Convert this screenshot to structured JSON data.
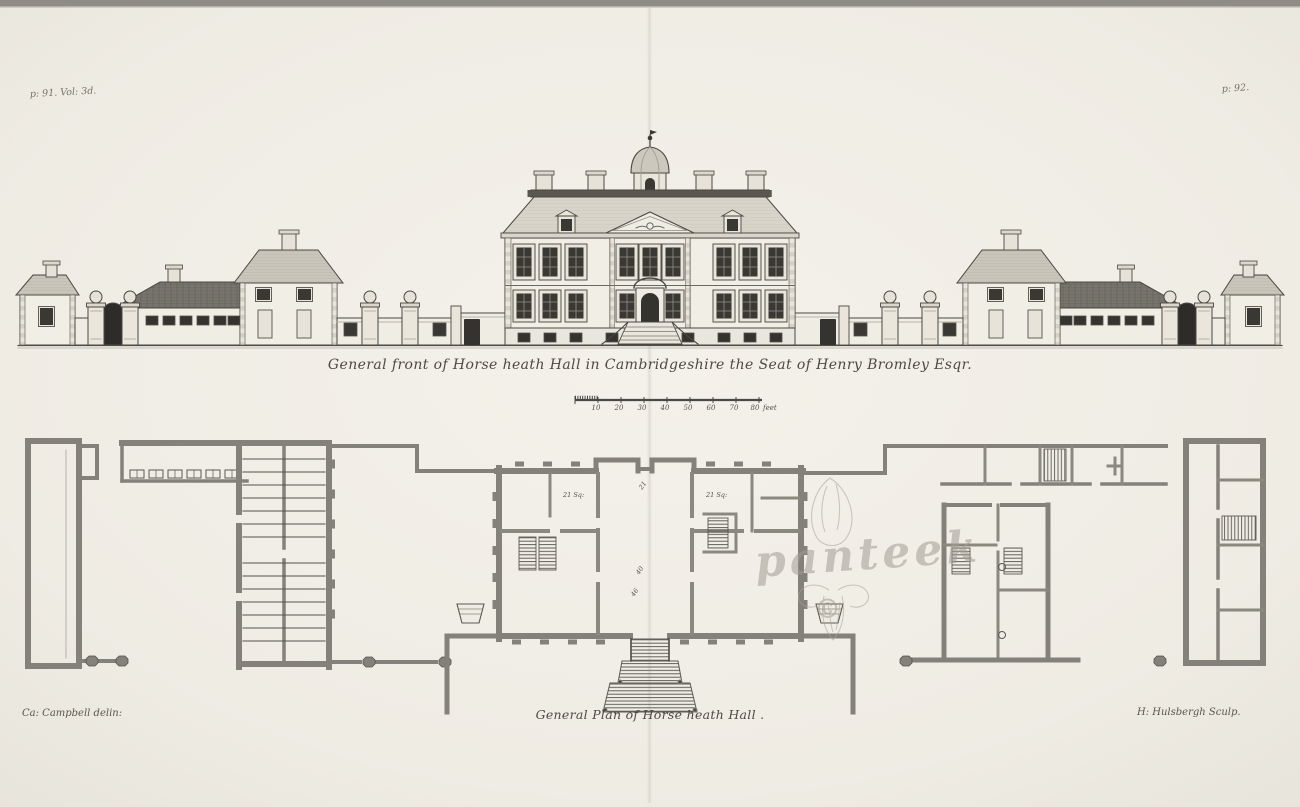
{
  "plate": {
    "page_ref_left": "p: 91. Vol: 3d.",
    "page_ref_right": "p: 92.",
    "elevation_caption": "General front of Horse heath Hall in Cambridgeshire the Seat of Henry Bromley Esqr.",
    "plan_caption": "General Plan of Horse heath Hall .",
    "credit_delineator": "Ca: Campbell delin:",
    "credit_engraver": "H: Hulsbergh Sculp.",
    "scale_bar": {
      "ticks": [
        "10",
        "20",
        "30",
        "40",
        "50",
        "60",
        "70",
        "80"
      ],
      "unit": "feet"
    },
    "plan_labels": {
      "left_room": "21 Sq:",
      "right_room": "21 Sq:",
      "hall_upper": "21",
      "hall_mid": "40",
      "hall_lower": "46"
    },
    "watermark": {
      "name": "panteek",
      "symbol": "©"
    },
    "colors": {
      "paper": "#f0ede5",
      "ink": "#4a463f",
      "wall_gray": "#84817a",
      "watermark_gray": "#a29c92"
    }
  }
}
